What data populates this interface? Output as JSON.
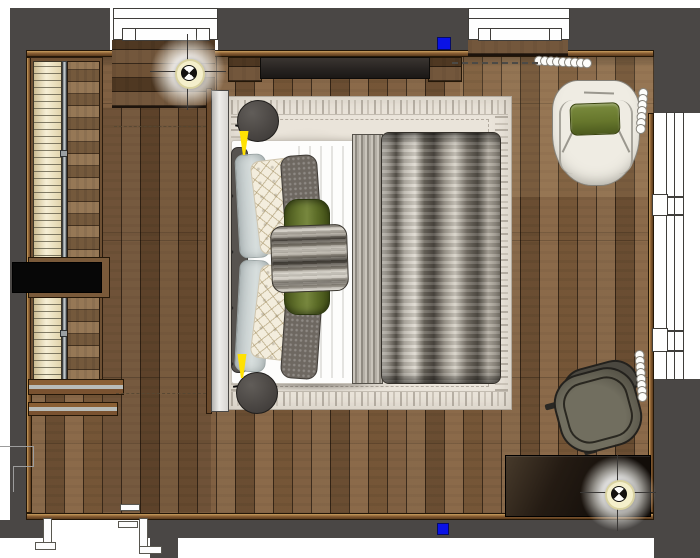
{
  "scene": {
    "type": "floor-plan",
    "room": "bedroom — top-down interior rendering",
    "view": "top-down"
  },
  "palette": {
    "wall": "#4a4745",
    "trim_wood": "#8a5f34",
    "floor_wood": "#7b5a3a",
    "plank_seam": "#241a10",
    "closet_light_door": "#eee0ba",
    "closet_wood_door": "#8a6a48",
    "tv_black": "#070707",
    "rug_cream": "#eae4da",
    "rug_pattern": "#a9a299",
    "mattress_white": "#fdfdfc",
    "headboard_panel": "#e8e6e2",
    "headboard_cushion": "#57534f",
    "pillow_bluegray": "#ccd4d4",
    "pillow_cream": "#f3eddd",
    "pillow_knit_gray": "#6e6861",
    "pillow_green": "#5f7020",
    "fur_throw_gray": "#8d887f",
    "knit_runner": "#b4afa6",
    "nightstand_gray": "#4b4744",
    "lamp_yellow": "#ffe103",
    "armchair_cream": "#efece3",
    "armchair_cushion_green": "#6d7d2f",
    "desk_chair_olive": "#6e6b5c",
    "desk_dark": "#191310",
    "outlet_blue": "#0a12e6",
    "window_frame": "#ffffff",
    "light_ring": "#f4efcb"
  },
  "elements": {
    "walls": {
      "label": "exterior walls"
    },
    "window_top_left": {
      "label": "window — top wall, left"
    },
    "window_top_right": {
      "label": "window — top wall, right"
    },
    "window_right": {
      "label": "window — right wall"
    },
    "door_bottom": {
      "label": "door opening — bottom wall left"
    },
    "wardrobe": {
      "label": "wardrobe closet with sliding doors"
    },
    "tv": {
      "label": "wall-mounted TV / black media panel"
    },
    "bench": {
      "label": "closet bench rails"
    },
    "console": {
      "label": "wall console above headboard"
    },
    "headboard": {
      "label": "headboard panel"
    },
    "bed": {
      "label": "bed with pillows, green bolster and gray fur throw"
    },
    "rug": {
      "label": "cream area rug with patterned border"
    },
    "nightstand_top": {
      "label": "round nightstand, top"
    },
    "nightstand_bottom": {
      "label": "round nightstand, bottom"
    },
    "lamp_top": {
      "label": "yellow table lamp, top nightstand"
    },
    "lamp_bottom": {
      "label": "yellow table lamp, bottom nightstand"
    },
    "armchair": {
      "label": "cream armchair with green cushion"
    },
    "desk_chair": {
      "label": "olive desk chair"
    },
    "desk": {
      "label": "dark desk against bottom wall"
    },
    "ceiling_light_1": {
      "label": "ceiling light fixture symbol"
    },
    "ceiling_light_2": {
      "label": "ceiling light fixture symbol"
    },
    "outlet_top": {
      "label": "blue electrical marker — top wall"
    },
    "outlet_bottom": {
      "label": "blue electrical marker — bottom wall"
    },
    "curtain_top": {
      "label": "sheer curtain loops — top window"
    },
    "curtain_right_upper": {
      "label": "sheer curtain loops — right window, upper"
    },
    "curtain_right_lower": {
      "label": "sheer curtain loops — right window, lower"
    }
  },
  "counts": {
    "ceiling_lights": 2,
    "outlet_markers": 2,
    "windows": 3,
    "doors": 1
  }
}
